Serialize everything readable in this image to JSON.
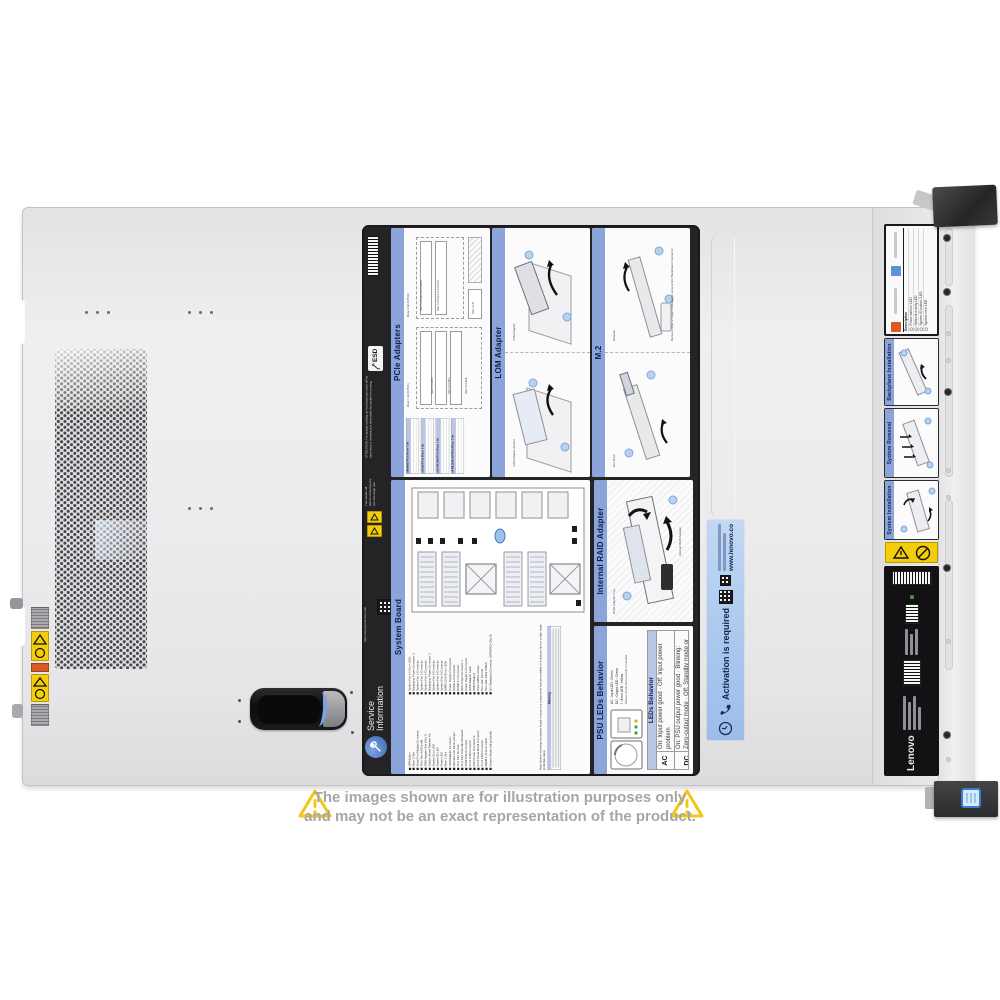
{
  "watermark": {
    "text": "COMPAN"
  },
  "disclaimer": {
    "line1": "The images shown are for illustration purposes only",
    "line2": "and may not be an exact representation of the product."
  },
  "colors": {
    "label_header_blue": "#8ba4da",
    "activation_blue": "#a9c6ea",
    "service_icon_blue": "#567fc9",
    "warning_yellow": "#f3cd0a",
    "latch_accent_blue": "#7aa2e6",
    "power_button_blue": "#3a7bd5"
  },
  "service_label": {
    "esd": "ESD",
    "attention": "ATTENTION: For proper cooling, do not leave top cover off for more than 2 minutes at a time while the system is running.",
    "power_off_warning": "Turn power off before removing any non-hot-swap part",
    "support_url": "https://support.lenovo.com",
    "branding_line1": "Service",
    "branding_line2": "Information",
    "pcie": {
      "title": "PCIe Adapters",
      "rear1": "Rear 1 kit (CPU1)",
      "rear2": "Rear 2 kit (CPU2)",
      "slots": [
        "Slot 1 FH/FL",
        "Slot 2 FH/FL",
        "Slot 3 FH/HL",
        "Slot 4 LP",
        "Slot 5 PCIe3 x16 FH/FL",
        "Slot 6 PCIe3 x16 FH/FL"
      ],
      "riser_tables": [
        "x8/x8/x8 PCIe Riser 1 kit",
        "x16/x8 PCIe Riser 1 kit",
        "x16 ML2/x8 PCIe Riser 1 kit",
        "x8 ML2/x8+x8 PCIe Riser 1 kit"
      ]
    },
    "lom": {
      "title": "LOM Adapter",
      "callout1": "LOM Adapter Airduct",
      "callout2": "LOM Adapter"
    },
    "m2": {
      "title": "M.2",
      "callout1": "M.2 Drive",
      "callout2": "Retainer",
      "note": "Remove Riser 2 Cage if installed to access M.2 Backplane Connector"
    },
    "system_board": {
      "title": "System Board",
      "legend_col1": [
        "NMI Button",
        "Riser 2 Slot",
        "Serial Port Module Connector",
        "PCIe Slot 4 (PCIe x8)",
        "RAID Adapter Slot (Slot 7)",
        "System Board Release Pin",
        "System Error LED",
        "System ID LED",
        "Power LED",
        "Riser 1 Slot",
        "LOM Adapter Connector",
        "Operator Info Panel Jumper",
        "Pins 1&2: Normal",
        "Pins 2&3: Override Password",
        "TPM/TCM JP Jumper",
        "Front USB Connector",
        "GPU Power Connector 2",
        "Front Panel Board Connector",
        "Front VGA Connector",
        "DIMM 1-12 Error LEDs",
        "System Board Lifting Handle"
      ],
      "legend_col2": [
        "System Fan 1-6 Error LEDs",
        "Backplane Power Connector 3",
        "System Fan 1 Connector",
        "System Fan 2 Connector",
        "System Fan 3 Connector",
        "Backplane Power Connector 2",
        "System Fan 4 Connector",
        "System Fan 5 Connector",
        "System Fan 6 Connector",
        "DIMM 13-24 Error LEDs",
        "Power Supply 2 Connector",
        "NVMe 2-3 Connector",
        "NVMe 0-1 Connector",
        "GPU Power Connector 1",
        "Power Supply 1 Connector",
        "RAID Adapter Label",
        "CMOS Battery",
        "Clear CMOS Jumper",
        "Pins 1&2: Normal",
        "Pins 2&3: Clear CMOS",
        "M.2 Backplane Connector (SATA/PCIe Slot 8)"
      ],
      "note": "Note: Before removing the system board, remove any components that are installed on it and put them in a safe, static-protective place.",
      "memory_header": "Memory"
    },
    "raid": {
      "title": "Internal RAID Adapter",
      "callout1": "RAID Adapter Tray",
      "callout2": "Internal RAID Adapter"
    },
    "psu": {
      "title": "PSU LEDs Behavior",
      "legend": [
        "AC : Input LED : Green",
        "DC : Output LED : Green",
        "! : Error LED : Yellow"
      ],
      "note": "Please check Setup Guide for details.",
      "table_header": "LEDs Behavior",
      "rows": [
        {
          "led": "AC",
          "behavior": "On: Input power good · Off: Input power problem"
        },
        {
          "led": "DC",
          "behavior": "On: PSU output power good · Blinking: Zero-output mode · Off: Standby mode or PSU error"
        },
        {
          "led": "!",
          "behavior": "On: PSU error · Off: PSU operates normally"
        }
      ]
    }
  },
  "activation": {
    "title": "Activation is required",
    "url": "www.lenovo.com/activate"
  },
  "strip": {
    "legend_header": "Description",
    "legend_rows": [
      "Power button / LED",
      "Network activity LED",
      "System ID button / LED",
      "System error LED"
    ],
    "sections": [
      "Backplane Installation",
      "System Removal",
      "System Installation"
    ],
    "brand": "Lenovo"
  }
}
